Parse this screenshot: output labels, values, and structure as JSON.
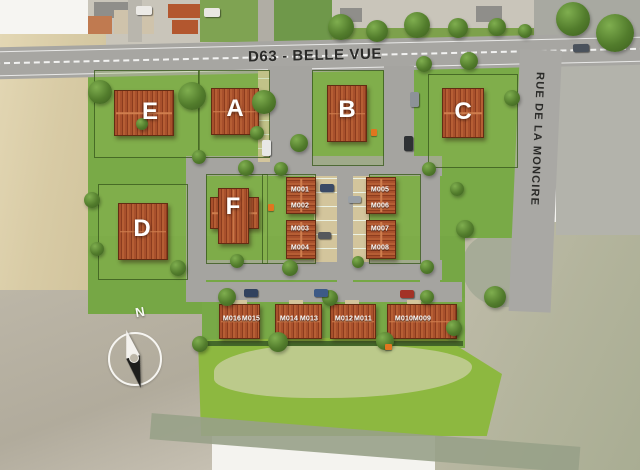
{
  "site_plan": {
    "road_top_label": "D63 - BELLE VUE",
    "road_right_label": "RUE DE LA MONCIRE",
    "compass_north": "N",
    "lots": {
      "e": "E",
      "a": "A",
      "b": "B",
      "c": "C",
      "d": "D",
      "f": "F"
    },
    "units": {
      "m001": "M001",
      "m002": "M002",
      "m003": "M003",
      "m004": "M004",
      "m005": "M005",
      "m006": "M006",
      "m007": "M007",
      "m008": "M008",
      "m009": "M009",
      "m010": "M010",
      "m011": "M011",
      "m012": "M012",
      "m013": "M013",
      "m014": "M014",
      "m015": "M015",
      "m016": "M016"
    },
    "colors": {
      "roof_red": "#a8502c",
      "grass_green": "#79aa47",
      "road_gray": "#a5a4a0",
      "sand_beige": "#d8cba5",
      "accent_orange": "#e0761f"
    }
  }
}
